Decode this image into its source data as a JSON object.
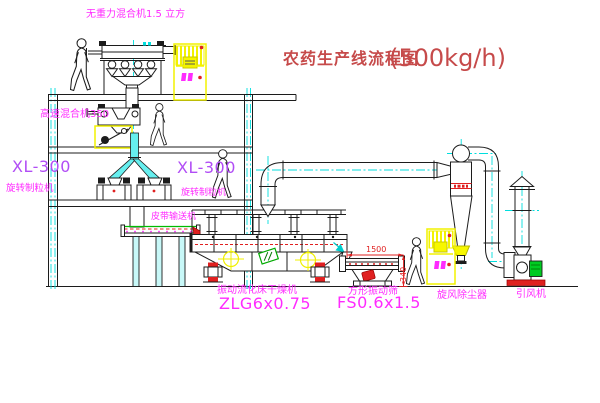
{
  "title": {
    "name": "农药生产线流程图",
    "capacity": "(500kg/h)"
  },
  "equipment": {
    "gravity_mixer": {
      "label": "无重力混合机1.5 立方"
    },
    "high_speed_mixer": {
      "label": "高速混合机350"
    },
    "granulator_left": {
      "model": "XL-300",
      "name": "旋转制粒机"
    },
    "granulator_right": {
      "model": "XL-300",
      "name": "旋转制粒机"
    },
    "belt_conveyor": {
      "label": "皮带输送机"
    },
    "dryer": {
      "name": "振动流化床干燥机",
      "model": "ZLG6x0.75"
    },
    "sieve": {
      "name": "方形振动筛",
      "model": "FS0.6x1.5"
    },
    "cyclone": {
      "name": "旋风除尘器"
    },
    "fan": {
      "name": "引风机"
    }
  },
  "dimensions": {
    "sieve_length": "1500",
    "sieve_height": "340"
  },
  "colors": {
    "label_magenta": "#ff2bff",
    "model_purple": "#b14df5",
    "title_red": "#c64a4a",
    "dimension_red": "#e02020",
    "line_black": "#1c1c1c",
    "centerline_cyan": "#00dede",
    "cabinet_yellow": "#f2f200",
    "motor_green": "#00cc22",
    "base_red": "#e02020"
  }
}
